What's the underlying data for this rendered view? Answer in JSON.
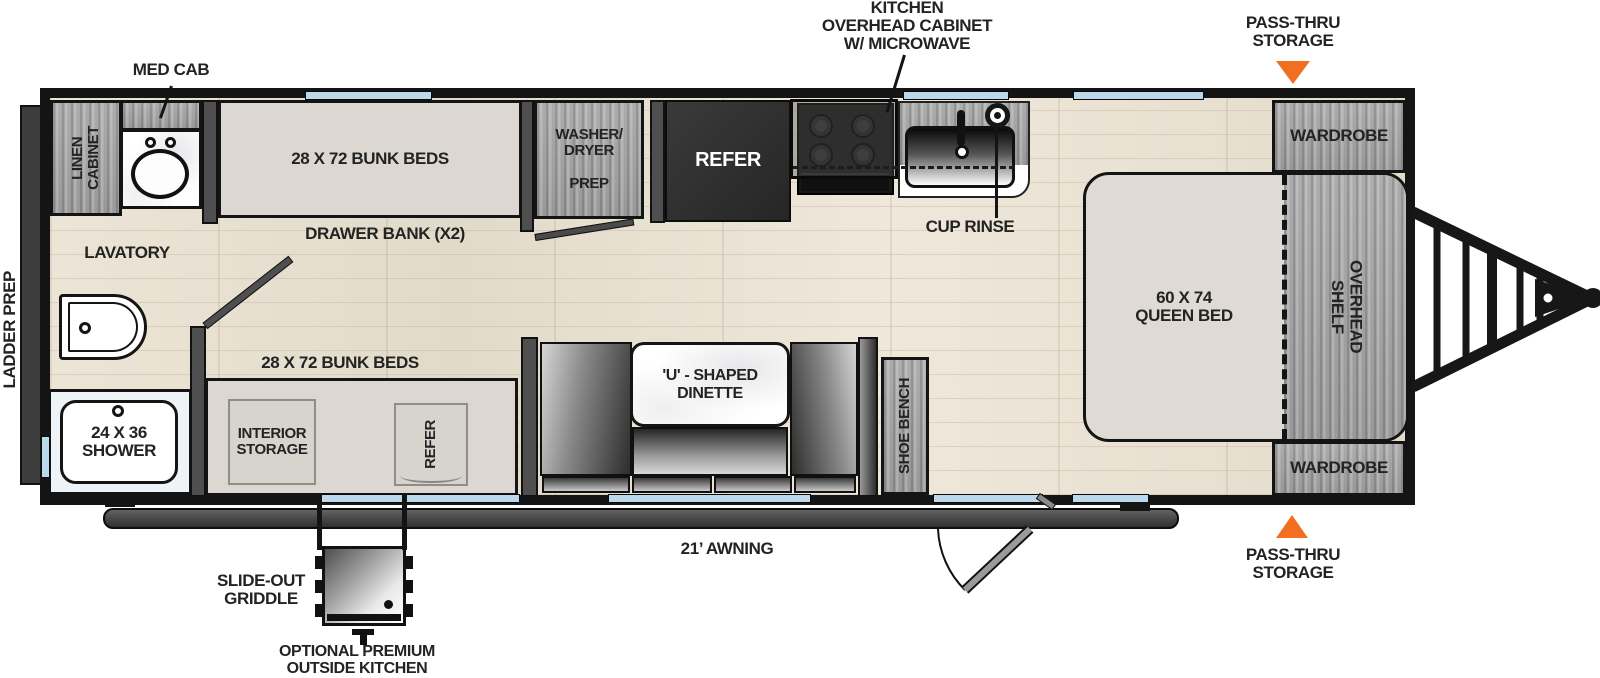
{
  "floorplan": {
    "exterior": {
      "med_cab": "MED CAB",
      "kitchen_overhead_cabinet": "KITCHEN\nOVERHEAD CABINET\nW/ MICROWAVE",
      "pass_thru_storage_top": "PASS-THRU\nSTORAGE",
      "pass_thru_storage_bottom": "PASS-THRU\nSTORAGE",
      "awning": "21’ AWNING",
      "slide_out_griddle": "SLIDE-OUT\nGRIDDLE",
      "optional_outside_kitchen": "OPTIONAL PREMIUM\nOUTSIDE KITCHEN",
      "ladder_prep": "LADDER PREP",
      "cup_rinse": "CUP RINSE"
    },
    "rooms": {
      "linen_cabinet": "LINEN\nCABINET",
      "bunk_top": "28 X 72 BUNK BEDS",
      "bunk_bottom": "28 X 72 BUNK BEDS",
      "drawer_bank": "DRAWER BANK (X2)",
      "lavatory": "LAVATORY",
      "shower": "24 X 36\nSHOWER",
      "washer_dryer_prep": "WASHER/\nDRYER\n\nPREP",
      "refer_main": "REFER",
      "refer_bunk": "REFER",
      "interior_storage": "INTERIOR\nSTORAGE",
      "dinette": "'U' - SHAPED\nDINETTE",
      "shoe_bench": "SHOE BENCH",
      "queen_bed": "60 X 74\nQUEEN BED",
      "overhead_shelf": "OVERHEAD\nSHELF",
      "wardrobe_top": "WARDROBE",
      "wardrobe_bottom": "WARDROBE"
    },
    "colors": {
      "accent_orange": "#F26F21",
      "window_blue": "#BCD8EC",
      "wall_black": "#141414",
      "cabinet_gray": "#A8A8A8",
      "floor_tan": "#E8E0D1",
      "bunk_fill": "#DCD8D1"
    }
  }
}
